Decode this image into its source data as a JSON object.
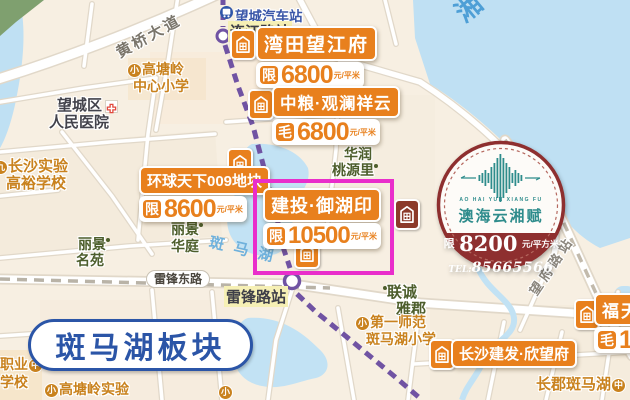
{
  "region_badge": "斑马湖板块",
  "water": {
    "river": "湘",
    "lake": "斑马湖"
  },
  "roads": {
    "huangqiao": "黄桥大道",
    "leifengdong": "雷锋东路"
  },
  "stations": {
    "bus": {
      "name": "望城汽车站"
    },
    "lianjiang": {
      "name": "连江路站"
    },
    "leifeng": {
      "name": "雷锋路站"
    },
    "wangfulu": {
      "name": "望府路站"
    }
  },
  "pois": [
    {
      "badge": "小",
      "line1": "高塘岭",
      "line2": "中心小学"
    },
    {
      "line1": "望城区",
      "line2": "人民医院"
    },
    {
      "badge": "九",
      "line1": "长沙实验",
      "line2": "高裕学校"
    },
    {
      "line1": "丽景",
      "line2": "名苑"
    },
    {
      "line1": "丽景",
      "line2": "华庭"
    },
    {
      "line1": "华润",
      "line2": "桃源里"
    },
    {
      "line1": "联诚",
      "line2": "雅郡"
    },
    {
      "badge": "小",
      "line1": "第一师范",
      "line2": "斑马湖小学"
    },
    {
      "badge": "中",
      "line1": "长郡斑马湖"
    },
    {
      "badge": "中",
      "line1": "职业",
      "line2": "学校"
    },
    {
      "badge": "小",
      "line1": "高塘岭实验"
    },
    {
      "badge": "小"
    }
  ],
  "listings": [
    {
      "name": "湾田望江府",
      "prefix": "限",
      "price": "6800",
      "unit": "元/平米"
    },
    {
      "name": "中粮·观澜祥云",
      "prefix": "毛",
      "price": "6800",
      "unit": "元/平米"
    },
    {
      "name": "环球天下009地块",
      "prefix": "限",
      "price": "8600",
      "unit": "元/平米"
    },
    {
      "name": "建投·御湖印",
      "prefix": "限",
      "price": "10500",
      "unit": "元/平米",
      "highlighted": true
    },
    {
      "name": "长沙建发·欣望府"
    },
    {
      "name": "福天",
      "prefix": "毛",
      "price": "1"
    }
  ],
  "promo": {
    "brand_en": "AO HAI YUN XIANG FU",
    "brand": "澳海云湘赋",
    "prefix": "限",
    "price": "8200",
    "unit": "元/平方米",
    "tel_label": "TEL:",
    "tel": "85665566"
  },
  "colors": {
    "accent_orange": "#E8801D",
    "highlight_magenta": "#E92ECB",
    "metro_purple": "#7053A3",
    "badge_blue": "#2B55A7",
    "promo_red": "#8E2F2F",
    "promo_teal": "#2E8C8C",
    "water_blue": "#BFE0F3"
  }
}
